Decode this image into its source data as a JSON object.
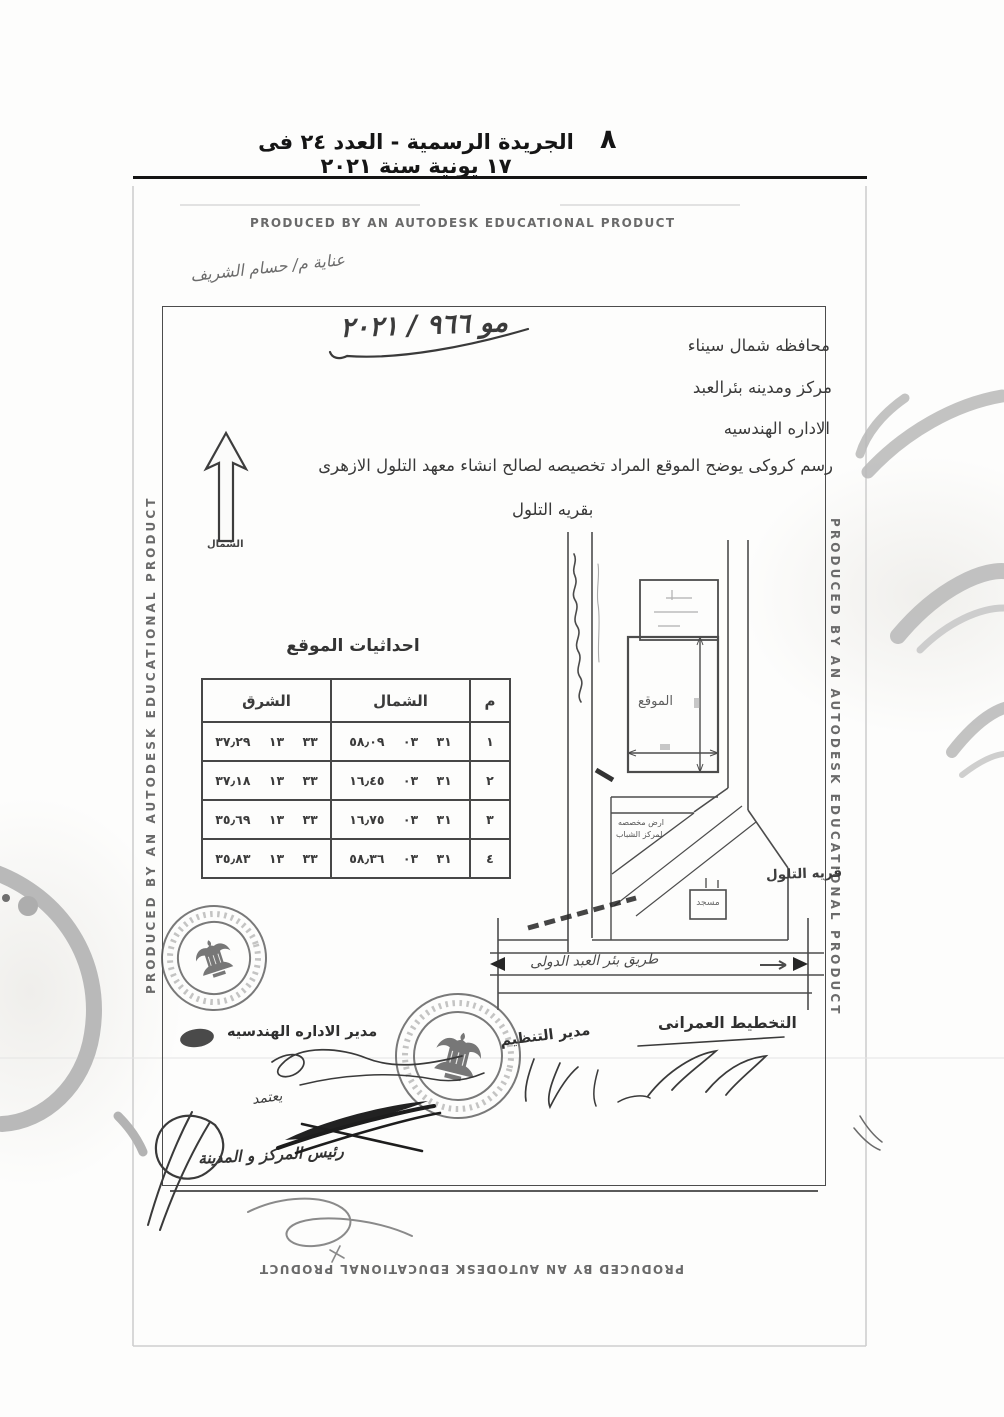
{
  "colors": {
    "ink": "#2e2e2e",
    "stamp_ink": "#565656",
    "watermark_gray": "#b9b9b9"
  },
  "header": {
    "title": "الجريدة الرسمية - العدد ٢٤ فى ١٧ يونية سنة ٢٠٢١",
    "page_number": "٨"
  },
  "autodesk": {
    "banner": "PRODUCED BY AN AUTODESK EDUCATIONAL PRODUCT"
  },
  "notes": {
    "attention": "عناية م/ حسام الشريف",
    "doc_number": "مو ٩٦٦ / ٢٠٢١"
  },
  "letterhead": {
    "line1": "محافظه شمال سيناء",
    "line2": "مركز ومدينه بئرالعبد",
    "line3": "الاداره الهندسيه",
    "subject": "رسم كروكى يوضح الموقع المراد تخصيصه لصالح انشاء معهد التلول الازهرى",
    "subject2": "بقريه التلول"
  },
  "compass": {
    "label": "الشمال"
  },
  "table": {
    "title": "احداثيات الموقع",
    "columns": [
      "م",
      "الشمال",
      "الشرق"
    ],
    "rows": [
      {
        "no": "١",
        "north": "٣١ ٠٣ ٥٨٫٠٩",
        "east": "٣٣ ١٣ ٣٧٫٢٩"
      },
      {
        "no": "٢",
        "north": "٣١ ٠٣ ١٦٫٤٥",
        "east": "٣٣ ١٣ ٣٧٫١٨"
      },
      {
        "no": "٣",
        "north": "٣١ ٠٣ ١٦٫٧٥",
        "east": "٣٣ ١٣ ٣٥٫٦٩"
      },
      {
        "no": "٤",
        "north": "٣١ ٠٣ ٥٨٫٣٦",
        "east": "٣٣ ١٣ ٣٥٫٨٣"
      }
    ]
  },
  "plan": {
    "site_label": "الموقع",
    "village_label": "قريه التلول",
    "mosque_label": "مسجد",
    "allocated_line1": "ارض مخصصه",
    "allocated_line2": "لمركز الشباب",
    "road_label": "طريق بئر العبد الدولى"
  },
  "signatures": {
    "urban_planning": "التخطيط العمرانى",
    "eng_admin_director": "مدير الاداره الهندسيه",
    "planning_director": "مدير التنظيم",
    "approved": "يعتمد",
    "city_head": "رئيس المركز و المدينة"
  }
}
